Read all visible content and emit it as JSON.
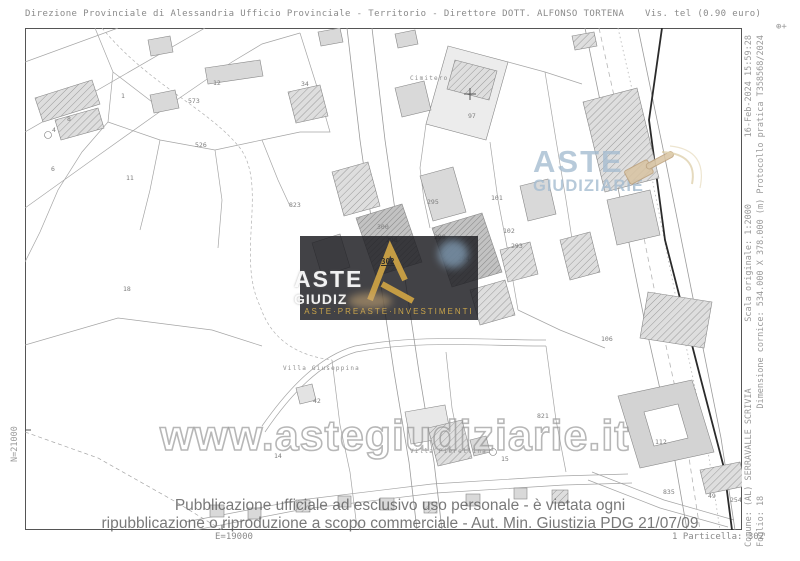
{
  "header": {
    "left": "Direzione Provinciale di Alessandria  Ufficio Provinciale - Territorio - Direttore DOTT. ALFONSO TORTENA",
    "right": "Vis. tel (0.90 euro)",
    "corner_mark": "⊕+"
  },
  "margins": {
    "right_col1": [
      "Comune: (AL) SERRAVALLE SCRIVIA",
      "Scala originale: 1:2000",
      "16-Feb-2024 15:59:28"
    ],
    "right_col2": [
      "Foglio: 18",
      "Dimensione cornice: 534.000 X 378.000 (m) Protocollo pratica T358568/2024"
    ],
    "left_vertical": "N=21000",
    "bottom_left": "E=19000",
    "bottom_right": "1 Particella: 302"
  },
  "watermarks": {
    "url": "www.astegiudiziarie.it",
    "disclaimer_line1": "Pubblicazione ufficiale ad esclusivo uso personale - è vietata ogni",
    "disclaimer_line2": "ripubblicazione o riproduzione a scopo commerciale - Aut. Min. Giustizia PDG 21/07/09",
    "logo_right": {
      "line1": "ASTE",
      "line2": "GIUDIZIARIE"
    },
    "logo_center": {
      "line1": "ASTE",
      "line2": "GIUDIZ",
      "tagline": "ASTE·PREASTE·INVESTIMENTI"
    },
    "colors": {
      "logo_blue": "#a6bdd1",
      "gold": "#c9a44a",
      "box_bg": "rgba(30,30,34,0.84)",
      "gavel_tan": "#d9c4a2"
    }
  },
  "map": {
    "target_parcel": {
      "label": "302",
      "x": 381,
      "y": 257
    },
    "labels": [
      {
        "t": "300",
        "x": 377,
        "y": 229
      },
      {
        "t": "298",
        "x": 386,
        "y": 242
      },
      {
        "t": "299",
        "x": 434,
        "y": 239
      },
      {
        "t": "295",
        "x": 427,
        "y": 204
      },
      {
        "t": "294",
        "x": 458,
        "y": 261
      },
      {
        "t": "101",
        "x": 491,
        "y": 200
      },
      {
        "t": "102",
        "x": 503,
        "y": 233
      },
      {
        "t": "293",
        "x": 511,
        "y": 248
      },
      {
        "t": "97",
        "x": 468,
        "y": 118
      },
      {
        "t": "12",
        "x": 213,
        "y": 85
      },
      {
        "t": "34",
        "x": 301,
        "y": 86
      },
      {
        "t": "573",
        "x": 188,
        "y": 103
      },
      {
        "t": "526",
        "x": 195,
        "y": 147
      },
      {
        "t": "8",
        "x": 67,
        "y": 121
      },
      {
        "t": "4",
        "x": 52,
        "y": 132
      },
      {
        "t": "1",
        "x": 121,
        "y": 98
      },
      {
        "t": "11",
        "x": 126,
        "y": 180
      },
      {
        "t": "6",
        "x": 51,
        "y": 171
      },
      {
        "t": "18",
        "x": 123,
        "y": 291
      },
      {
        "t": "823",
        "x": 289,
        "y": 207
      },
      {
        "t": "106",
        "x": 601,
        "y": 341
      },
      {
        "t": "821",
        "x": 537,
        "y": 418
      },
      {
        "t": "42",
        "x": 313,
        "y": 403
      },
      {
        "t": "14",
        "x": 274,
        "y": 458
      },
      {
        "t": "15",
        "x": 501,
        "y": 461
      },
      {
        "t": "112",
        "x": 655,
        "y": 444
      },
      {
        "t": "835",
        "x": 663,
        "y": 494
      },
      {
        "t": "254",
        "x": 730,
        "y": 502
      },
      {
        "t": "49",
        "x": 708,
        "y": 498
      }
    ],
    "place_labels": [
      {
        "t": "Cimitero",
        "x": 410,
        "y": 80
      },
      {
        "t": "Villa Giuseppina",
        "x": 283,
        "y": 370
      },
      {
        "t": "Villa Pierellina",
        "x": 410,
        "y": 453
      }
    ]
  }
}
